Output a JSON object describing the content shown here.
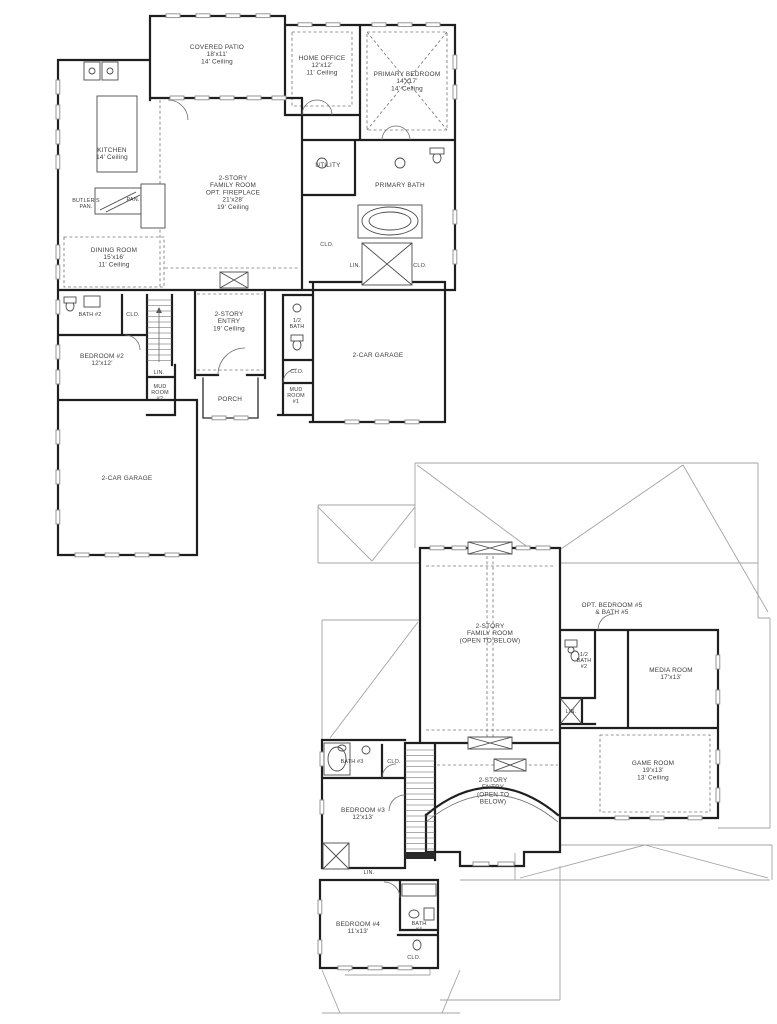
{
  "colors": {
    "wall": "#1f1f1f",
    "dashed_line": "#7a7a7a",
    "roof_line": "#a3a3a3",
    "text": "#3c3c3c",
    "background": "#ffffff"
  },
  "floor1": {
    "labels": {
      "covered_patio": [
        "COVERED PATIO",
        "18'x11'",
        "14' Ceiling"
      ],
      "home_office": [
        "HOME OFFICE",
        "12'x12'",
        "11' Ceiling"
      ],
      "primary_bedroom": [
        "PRIMARY BEDROOM",
        "14'x17'",
        "14' Ceiling"
      ],
      "kitchen": [
        "KITCHEN",
        "14' Ceiling"
      ],
      "family_room": [
        "2-STORY",
        "FAMILY ROOM",
        "OPT. FIREPLACE",
        "21'x28'",
        "19' Ceiling"
      ],
      "utility": [
        "UTILITY"
      ],
      "primary_bath": [
        "PRIMARY BATH"
      ],
      "butlers_pantry": [
        "BUTLER'S",
        "PAN."
      ],
      "pantry": [
        "PAN."
      ],
      "dining_room": [
        "DINING ROOM",
        "15'x16'",
        "11' Ceiling"
      ],
      "bath2": [
        "BATH #2"
      ],
      "bath2_clo": [
        "CLO."
      ],
      "bedroom2": [
        "BEDROOM #2",
        "12'x12'"
      ],
      "lin1": [
        "LIN."
      ],
      "mud_room2": [
        "MUD",
        "ROOM",
        "#2"
      ],
      "entry": [
        "2-STORY",
        "ENTRY",
        "19' Ceiling"
      ],
      "half_bath": [
        "1/2",
        "BATH"
      ],
      "primary_clo": [
        "CLO."
      ],
      "primary_lin": [
        "LIN."
      ],
      "primary_clo2": [
        "CLO."
      ],
      "mud_clo": [
        "CLO."
      ],
      "mud_room1": [
        "MUD",
        "ROOM",
        "#1"
      ],
      "porch": [
        "PORCH"
      ],
      "garage_right": [
        "2-CAR GARAGE"
      ],
      "garage_left": [
        "2-CAR GARAGE"
      ]
    }
  },
  "floor2": {
    "labels": {
      "family_room_open": [
        "2-STORY",
        "FAMILY ROOM",
        "(OPEN TO BELOW)"
      ],
      "opt_bedroom5": [
        "OPT. BEDROOM #5",
        "& BATH #5"
      ],
      "half_bath2": [
        "1/2",
        "BATH",
        "#2"
      ],
      "media_room": [
        "MEDIA ROOM",
        "17'x13'"
      ],
      "lin": [
        "LIN."
      ],
      "game_room": [
        "GAME ROOM",
        "19'x13'",
        "13' Ceiling"
      ],
      "entry_open": [
        "2-STORY",
        "ENTRY",
        "(OPEN TO",
        "BELOW)"
      ],
      "bath3": [
        "BATH #3"
      ],
      "bath3_clo": [
        "CLO."
      ],
      "bedroom3": [
        "BEDROOM #3",
        "12'x13'"
      ],
      "lin2": [
        "LIN."
      ],
      "bedroom4": [
        "BEDROOM #4",
        "11'x13'"
      ],
      "bath4": [
        "BATH",
        "#4"
      ],
      "bath4_clo": [
        "CLO."
      ]
    }
  }
}
